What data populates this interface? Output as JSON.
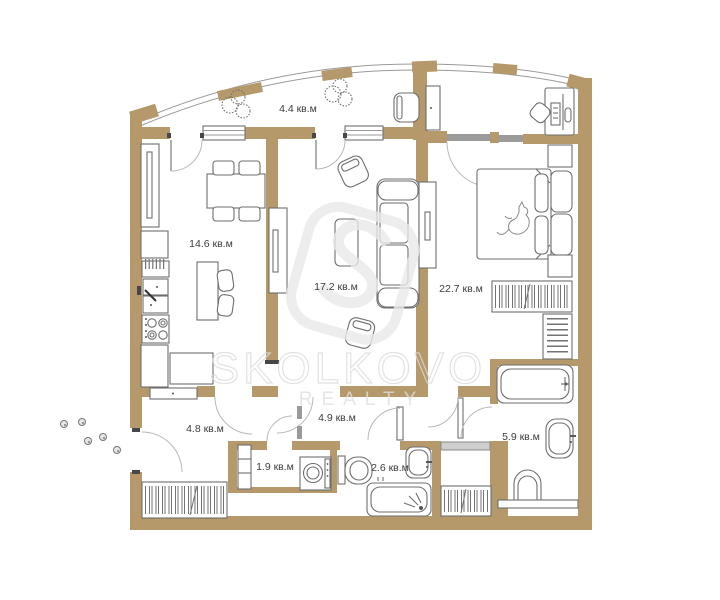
{
  "watermark": {
    "name": "SKOLKOVO",
    "subtitle": "REALTY"
  },
  "rooms": [
    {
      "id": "balcony",
      "area": "4.4 кв.м"
    },
    {
      "id": "kitchen",
      "area": "14.6 кв.м"
    },
    {
      "id": "living-room",
      "area": "17.2 кв.м"
    },
    {
      "id": "bedroom",
      "area": "22.7 кв.м"
    },
    {
      "id": "hallway",
      "area": "4.8 кв.м"
    },
    {
      "id": "corridor",
      "area": "4.9 кв.м"
    },
    {
      "id": "storage",
      "area": "1.9 кв.м"
    },
    {
      "id": "wc",
      "area": "2.6 кв.м"
    },
    {
      "id": "bathroom",
      "area": "5.9 кв.м"
    }
  ],
  "colors": {
    "wall": "#b5996a",
    "fixture_outline": "#6e6e6e",
    "glazing": "#9b9b9b",
    "watermark": "#dcdcdc",
    "label": "#3d3d3d"
  }
}
